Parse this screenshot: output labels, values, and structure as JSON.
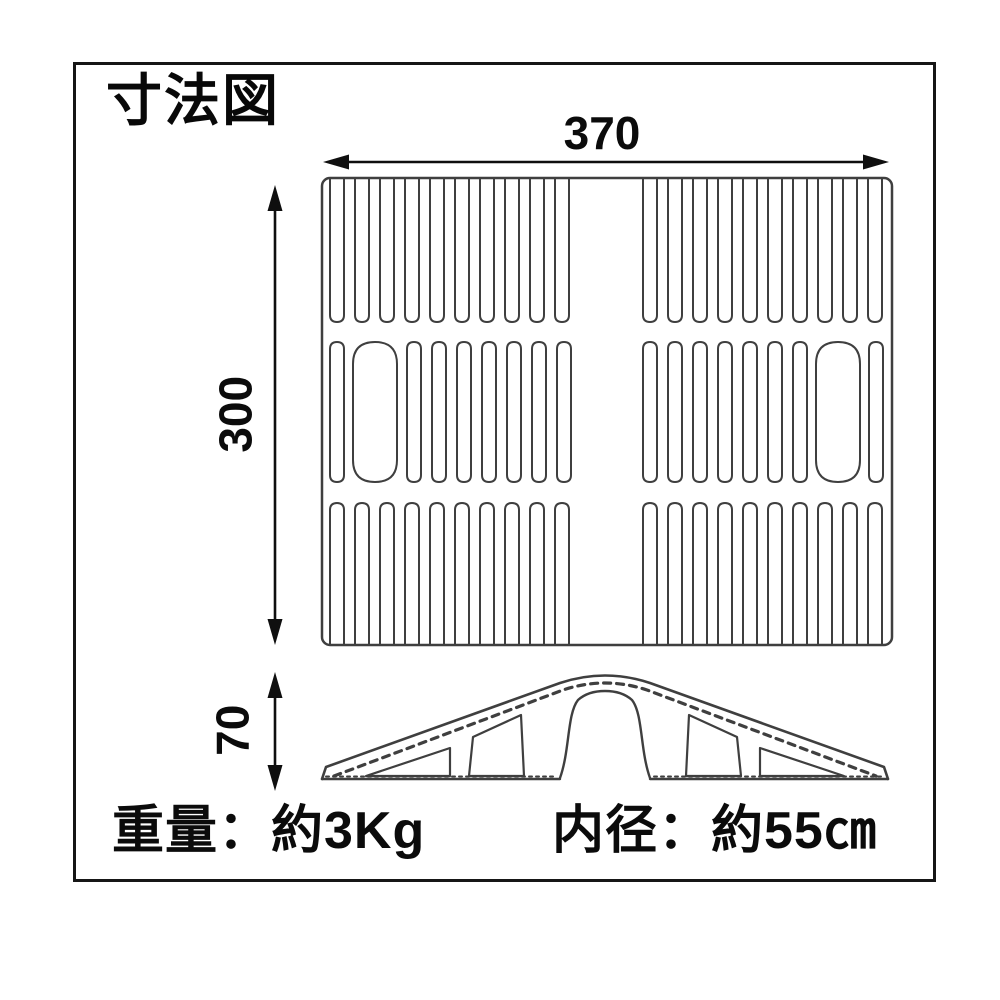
{
  "title": "寸法図",
  "labels": {
    "width": "370",
    "height": "300",
    "side_height": "70"
  },
  "specs": {
    "weight": "重量：約3Kg",
    "inner_diameter": "内径：約55㎝"
  },
  "figure": {
    "colors": {
      "line": "#3f3f3f",
      "dim": "#0f0f0f",
      "border": "#161616",
      "background": "#ffffff"
    },
    "top_view": {
      "frame": {
        "x": 322,
        "y": 178,
        "w": 570,
        "h": 467,
        "r": 8
      },
      "slot_width": 14,
      "rows": [
        {
          "open": "top",
          "y0": 178,
          "y1": 322,
          "slots": [
            330,
            355,
            380,
            405,
            430,
            455,
            480,
            505,
            530,
            555,
            643,
            668,
            693,
            718,
            743,
            768,
            793,
            818,
            843,
            868
          ]
        },
        {
          "open": "none",
          "y0": 342,
          "y1": 482,
          "slots": [
            330,
            {
              "x": 353,
              "w": 44
            },
            407,
            432,
            457,
            482,
            507,
            532,
            557,
            643,
            668,
            693,
            718,
            743,
            768,
            793,
            {
              "x": 816,
              "w": 44
            },
            869
          ]
        },
        {
          "open": "bottom",
          "y0": 503,
          "y1": 645,
          "slots": [
            330,
            355,
            380,
            405,
            430,
            455,
            480,
            505,
            530,
            555,
            643,
            668,
            693,
            718,
            743,
            768,
            793,
            818,
            843,
            868
          ]
        }
      ]
    },
    "side_view": {
      "paths": [
        {
          "name": "outer-profile",
          "d": "M322,779 L326,767 L560,683 Q605,668 650,683 L884,767 L888,779",
          "sw": 2.6
        },
        {
          "name": "slope-hatch",
          "d": "M334,776 L563,690 Q605,676 647,690 L876,776",
          "sw": 3.2,
          "dash": "7 6"
        },
        {
          "name": "cutout-left-outer",
          "d": "M366,776 L450,748 L450,776 Z"
        },
        {
          "name": "cutout-left-inner",
          "d": "M469,776 L473,737 L521,715 L524,776 Z"
        },
        {
          "name": "arch-tunnel",
          "d": "M560,778 C570,750 567,714 578,700 Q588,691 605,691 Q622,691 632,700 C643,714 640,750 650,778",
          "sw": 2.4
        },
        {
          "name": "cutout-right-inner",
          "d": "M686,776 L689,715 L737,737 L741,776 Z"
        },
        {
          "name": "cutout-right-outer",
          "d": "M760,776 L760,748 L844,776 Z"
        },
        {
          "name": "base-left",
          "d": "M322,779 L560,779",
          "sw": 2.4
        },
        {
          "name": "base-right",
          "d": "M650,779 L888,779",
          "sw": 2.4
        },
        {
          "name": "base-left-serration",
          "d": "M326,776.5 L556,776.5",
          "sw": 2,
          "dash": "3 4"
        },
        {
          "name": "base-right-serration",
          "d": "M654,776.5 L884,776.5",
          "sw": 2,
          "dash": "3 4"
        }
      ]
    },
    "arrows": [
      {
        "name": "width-arrow",
        "x1": 323,
        "y1": 162,
        "x2": 889,
        "y2": 162
      },
      {
        "name": "height-arrow",
        "x1": 275,
        "y1": 185,
        "x2": 275,
        "y2": 645
      },
      {
        "name": "side-height-arrow",
        "x1": 275,
        "y1": 672,
        "x2": 275,
        "y2": 791
      }
    ]
  }
}
